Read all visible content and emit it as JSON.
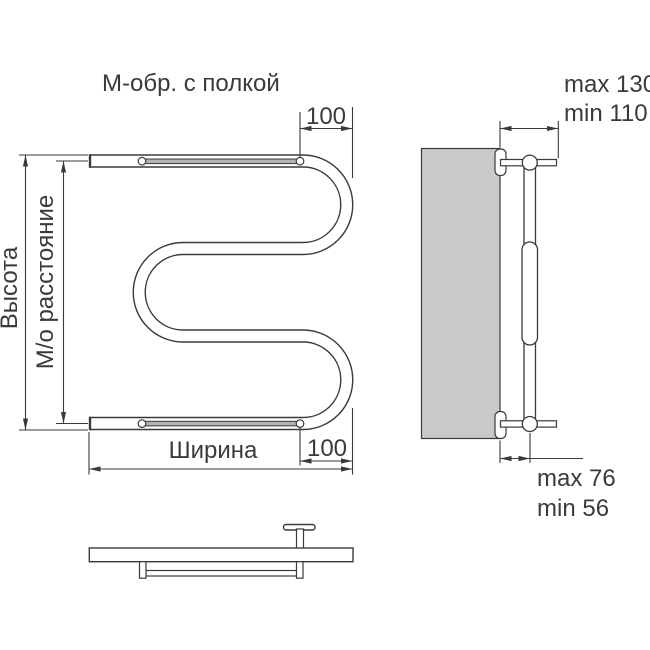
{
  "title": "М-обр. с полкой",
  "front_view": {
    "height_label": "Высота",
    "axial_distance_label": "М/о расстояние",
    "width_label": "Ширина",
    "shelf_offset_top": "100",
    "shelf_offset_bottom": "100"
  },
  "side_view": {
    "wall_distance_max": "max 130",
    "wall_distance_min": "min 110",
    "axis_distance_max": "max 76",
    "axis_distance_min": "min 56"
  },
  "colors": {
    "line": "#3a3a3a",
    "text": "#3a3a3a",
    "wall_fill": "#c9c9c9",
    "shelf_rod_fill": "#b3b3b3"
  }
}
